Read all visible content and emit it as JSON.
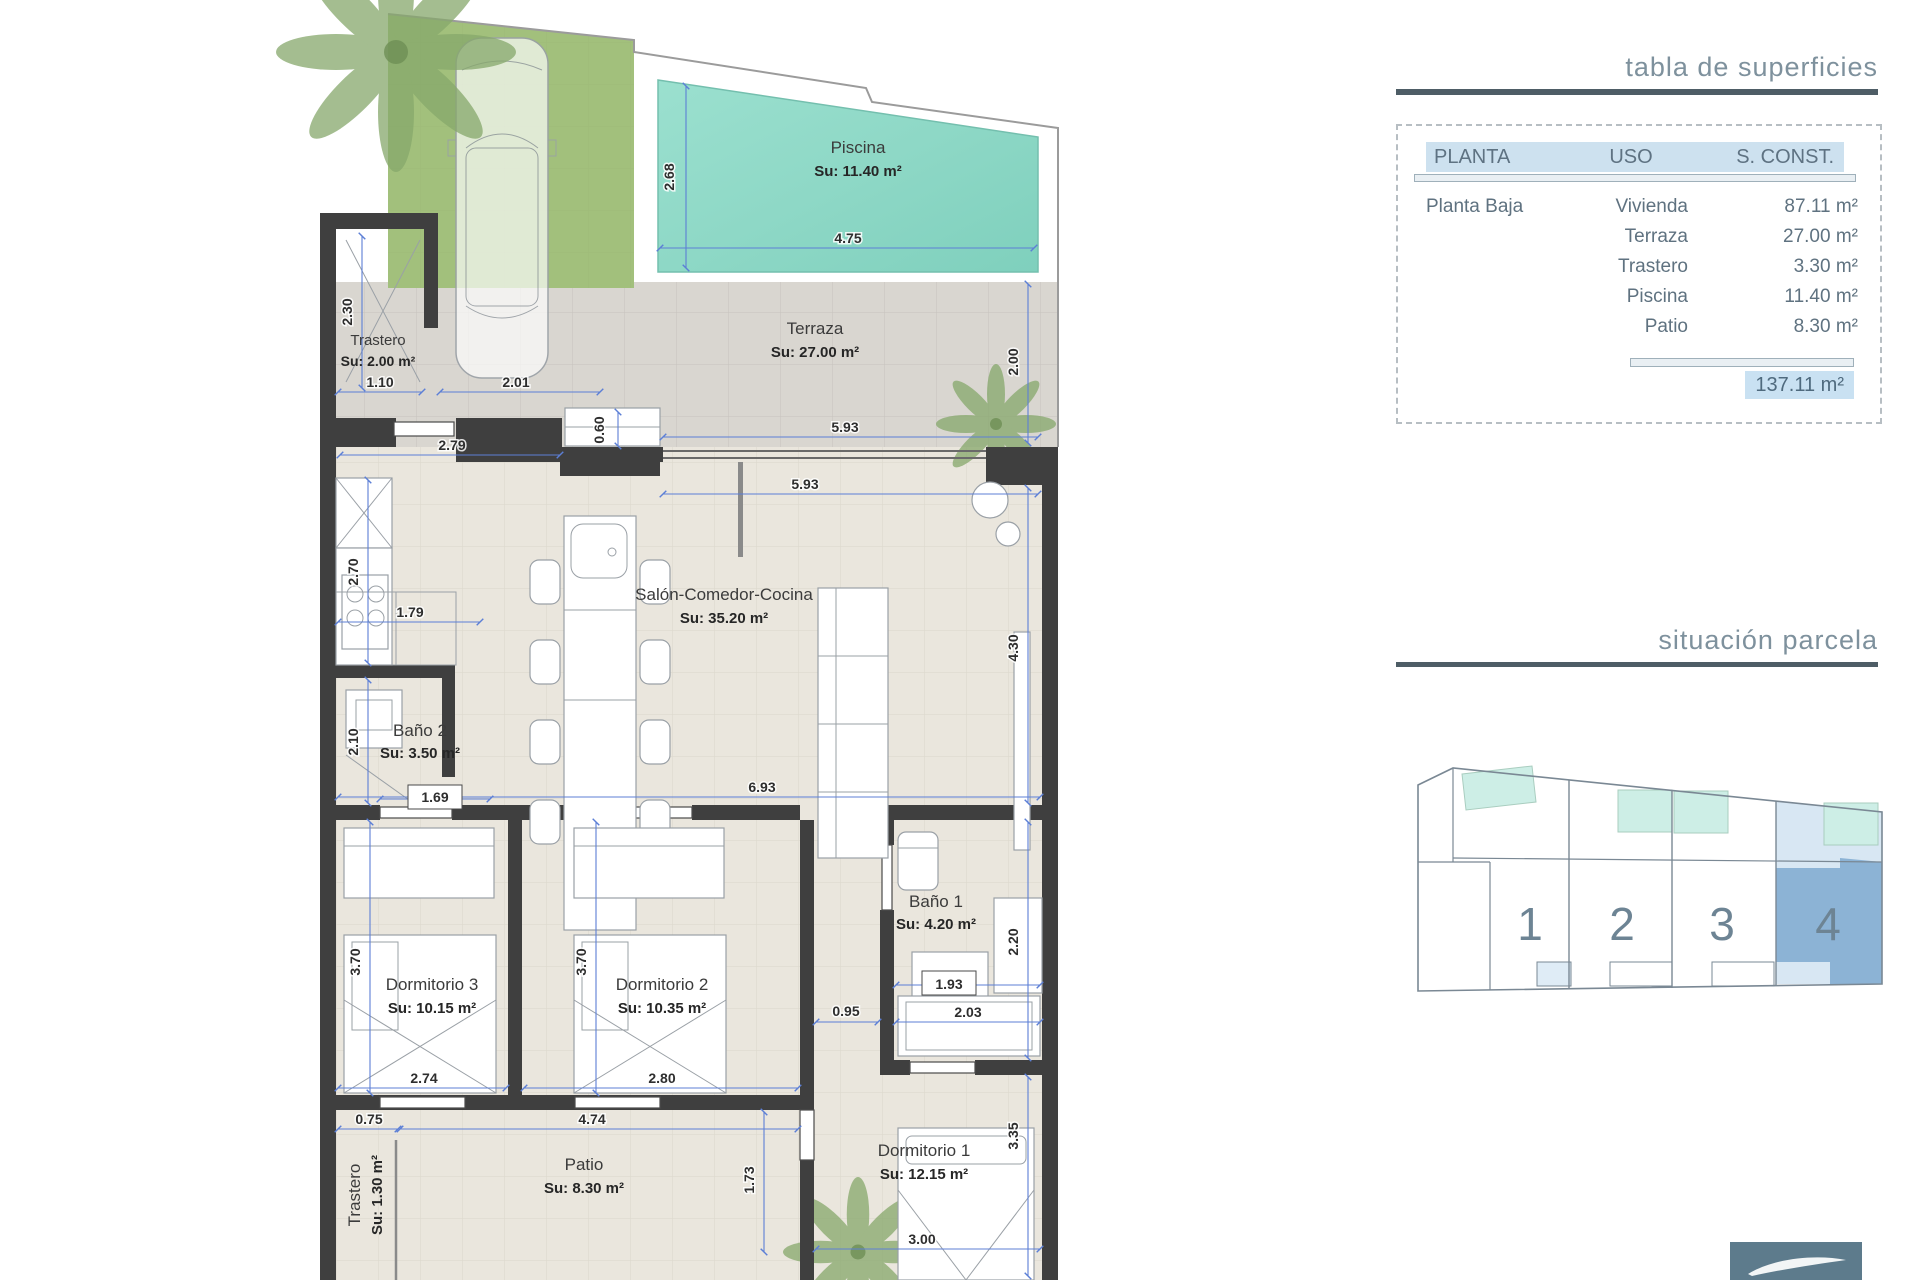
{
  "floorplan": {
    "rooms": [
      {
        "name": "Piscina",
        "area": "Su: 11.40 m²"
      },
      {
        "name": "Terraza",
        "area": "Su: 27.00 m²"
      },
      {
        "name": "Trastero",
        "area": "Su: 2.00 m²"
      },
      {
        "name": "Salón-Comedor-Cocina",
        "area": "Su: 35.20 m²"
      },
      {
        "name": "Baño 2",
        "area": "Su: 3.50 m²"
      },
      {
        "name": "Baño 1",
        "area": "Su: 4.20 m²"
      },
      {
        "name": "Dormitorio 3",
        "area": "Su: 10.15 m²"
      },
      {
        "name": "Dormitorio 2",
        "area": "Su: 10.35 m²"
      },
      {
        "name": "Dormitorio 1",
        "area": "Su: 12.15 m²"
      },
      {
        "name": "Patio",
        "area": "Su: 8.30 m²"
      },
      {
        "name": "Trastero",
        "area": "Su: 1.30 m²"
      }
    ],
    "dimensions": {
      "pool_height": "2.68",
      "pool_width": "4.75",
      "terraza_width": "5.93",
      "terraza_height": "2.00",
      "trastero_height": "2.30",
      "trastero_door": "1.10",
      "driveway_width": "2.01",
      "entry_step": "0.60",
      "kitchen_width": "2.79",
      "salon_top_width": "5.93",
      "kitchen_height": "2.70",
      "kitchen_depth": "1.79",
      "bano2_height": "2.10",
      "bano2_door": "1.69",
      "salon_width": "6.93",
      "salon_height": "4.30",
      "bano1_height": "2.20",
      "bano1_sink": "1.93",
      "hall_width": "0.95",
      "bano1_shower": "2.03",
      "dorm3_height": "3.70",
      "dorm2_height": "3.70",
      "dorm3_width": "2.74",
      "dorm2_width": "2.80",
      "dorm1_height": "3.35",
      "patio_offset": "0.75",
      "patio_width": "4.74",
      "patio_height": "1.73",
      "dorm1_width": "3.00"
    }
  },
  "surface_table": {
    "title": "tabla de superficies",
    "headers": [
      "PLANTA",
      "USO",
      "S. CONST."
    ],
    "rows": [
      {
        "planta": "Planta Baja",
        "uso": "Vivienda",
        "sup": "87.11 m²"
      },
      {
        "planta": "",
        "uso": "Terraza",
        "sup": "27.00 m²"
      },
      {
        "planta": "",
        "uso": "Trastero",
        "sup": "3.30 m²"
      },
      {
        "planta": "",
        "uso": "Piscina",
        "sup": "11.40 m²"
      },
      {
        "planta": "",
        "uso": "Patio",
        "sup": "8.30 m²"
      }
    ],
    "total": "137.11 m²"
  },
  "parcela": {
    "title": "situación parcela",
    "units": [
      "1",
      "2",
      "3",
      "4"
    ],
    "highlighted_unit": "4"
  },
  "colors": {
    "wall": "#3f3f3f",
    "pool": "#8ed8c6",
    "grass": "#a2c07c",
    "terrace": "#d9d6d0",
    "floor": "#eae6dd",
    "dimension": "#5c7fd6",
    "header_band": "#cde1ef",
    "total_highlight": "#c9e1f2",
    "title_bar": "#4e5d66",
    "parcel_highlight": "#8cb3d5",
    "parcel_pool": "#cdeee6",
    "logo_bg": "#5d7b8c"
  }
}
